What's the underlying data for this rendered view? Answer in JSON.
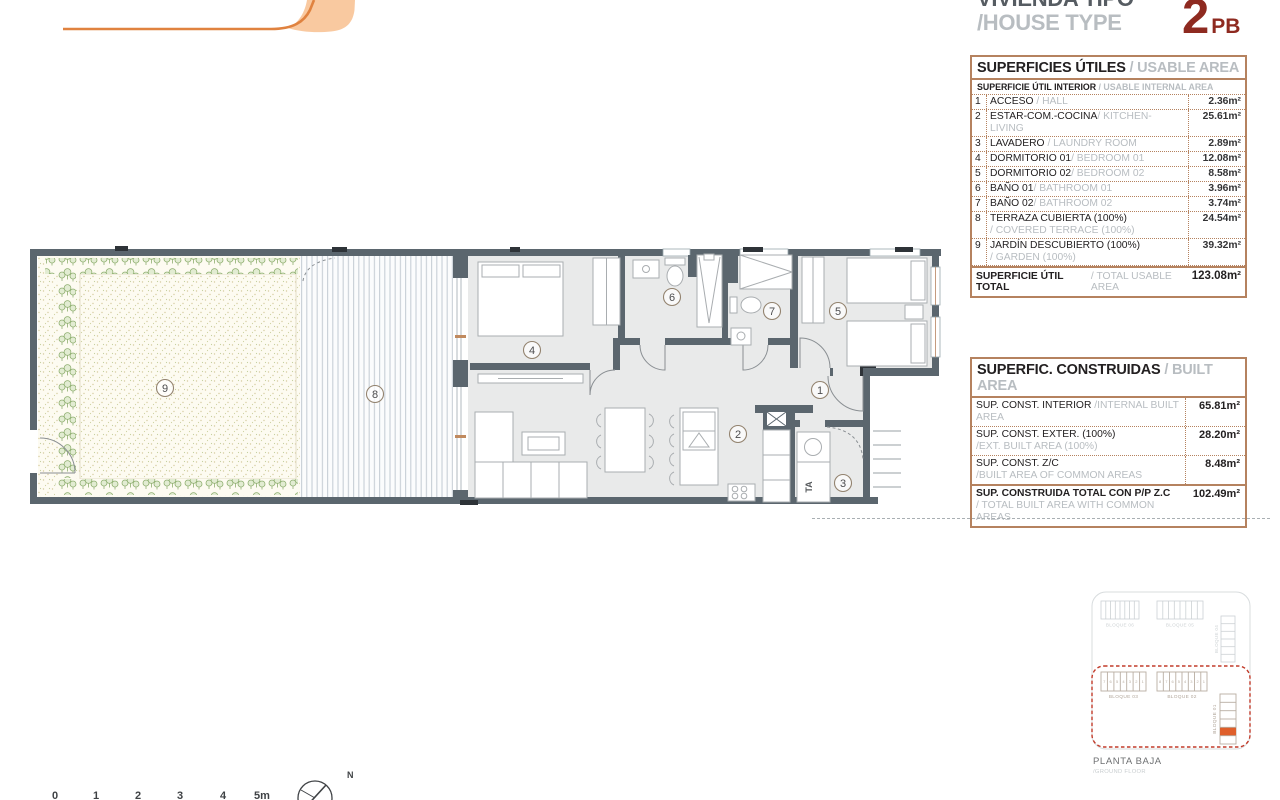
{
  "header": {
    "title_es": "VIVIENDA TIPO",
    "title_en": "/HOUSE TYPE",
    "type_number": "2",
    "type_suffix": "PB"
  },
  "usable_table": {
    "title_es": "SUPERFICIES ÚTILES",
    "title_en": " / USABLE AREA",
    "subtitle_es": "SUPERFICIE ÚTIL INTERIOR",
    "subtitle_en": " / USABLE INTERNAL AREA",
    "rows": [
      {
        "num": "1",
        "es": "ACCESO",
        "en": "/ HALL",
        "value": "2.36m²"
      },
      {
        "num": "2",
        "es": "ESTAR-COM.-COCINA",
        "en": "/ KITCHEN-LIVING",
        "value": "25.61m²"
      },
      {
        "num": "3",
        "es": "LAVADERO",
        "en": "/ LAUNDRY ROOM",
        "value": "2.89m²"
      },
      {
        "num": "4",
        "es": "DORMITORIO 01",
        "en": "/ BEDROOM 01",
        "value": "12.08m²"
      },
      {
        "num": "5",
        "es": "DORMITORIO 02",
        "en": "/ BEDROOM 02",
        "value": "8.58m²"
      },
      {
        "num": "6",
        "es": "BAÑO 01",
        "en": "/ BATHROOM 01",
        "value": "3.96m²"
      },
      {
        "num": "7",
        "es": "BAÑO 02",
        "en": "/ BATHROOM 02",
        "value": "3.74m²"
      },
      {
        "num": "8",
        "es": "TERRAZA CUBIERTA (100%)",
        "en": "/ COVERED TERRACE (100%)",
        "value": "24.54m²"
      },
      {
        "num": "9",
        "es": "JARDÍN DESCUBIERTO (100%)",
        "en": "/ GARDEN (100%)",
        "value": "39.32m²"
      }
    ],
    "total_es": "SUPERFICIE ÚTIL TOTAL",
    "total_en": "/ TOTAL USABLE AREA",
    "total_value": "123.08m²"
  },
  "built_table": {
    "title_es": "SUPERFIC. CONSTRUIDAS",
    "title_en": " / BUILT AREA",
    "rows": [
      {
        "es": "SUP. CONST. INTERIOR",
        "en": "/INTERNAL BUILT AREA",
        "value": "65.81m²"
      },
      {
        "es": "SUP. CONST. EXTER. (100%)",
        "en": "/EXT. BUILT AREA (100%)",
        "value": "28.20m²"
      },
      {
        "es": "SUP. CONST. Z/C",
        "en": "/BUILT AREA OF COMMON AREAS",
        "value": "8.48m²"
      }
    ],
    "total_es": "SUP. CONSTRUIDA TOTAL CON P/P Z.C",
    "total_en": "/ TOTAL BUILT AREA WITH COMMON AREAS",
    "total_value": "102.49m²"
  },
  "floor_plan": {
    "rooms": {
      "hall": "1",
      "kitchen_living": "2",
      "laundry": "3",
      "bedroom01": "4",
      "bedroom02": "5",
      "bath01": "6",
      "bath02": "7",
      "terrace": "8",
      "garden": "9"
    },
    "laundry_tag": "TA"
  },
  "site_plan": {
    "block06": "BLOQUE 06",
    "block05": "BLOQUE 05",
    "block04": "BLOQUE 04",
    "block03": "BLOQUE 03",
    "block02": "BLOQUE 02",
    "block01": "BLOQUE 01",
    "b03_units": [
      "7",
      "6",
      "5",
      "4",
      "3",
      "2",
      "1"
    ],
    "b02_units": [
      "8",
      "7",
      "6",
      "5",
      "4",
      "3",
      "2",
      "1"
    ],
    "caption_es": "PLANTA BAJA",
    "caption_en": "/GROUND FLOOR"
  },
  "scale_bar": {
    "labels": [
      "0",
      "1",
      "2",
      "3",
      "4",
      "5m"
    ]
  },
  "compass": {
    "north": "N"
  },
  "colors": {
    "accent_orange": "#E8873B",
    "logo_fill": "#F9C9A0",
    "brick_red": "#8E2A20",
    "table_border": "#B5825F",
    "wall_gray": "#5B666E",
    "muted_text": "#B8BDC1",
    "site_red": "#C23B2A",
    "unit_orange": "#DF5F2B",
    "hedge_green": "#8FAF70"
  }
}
